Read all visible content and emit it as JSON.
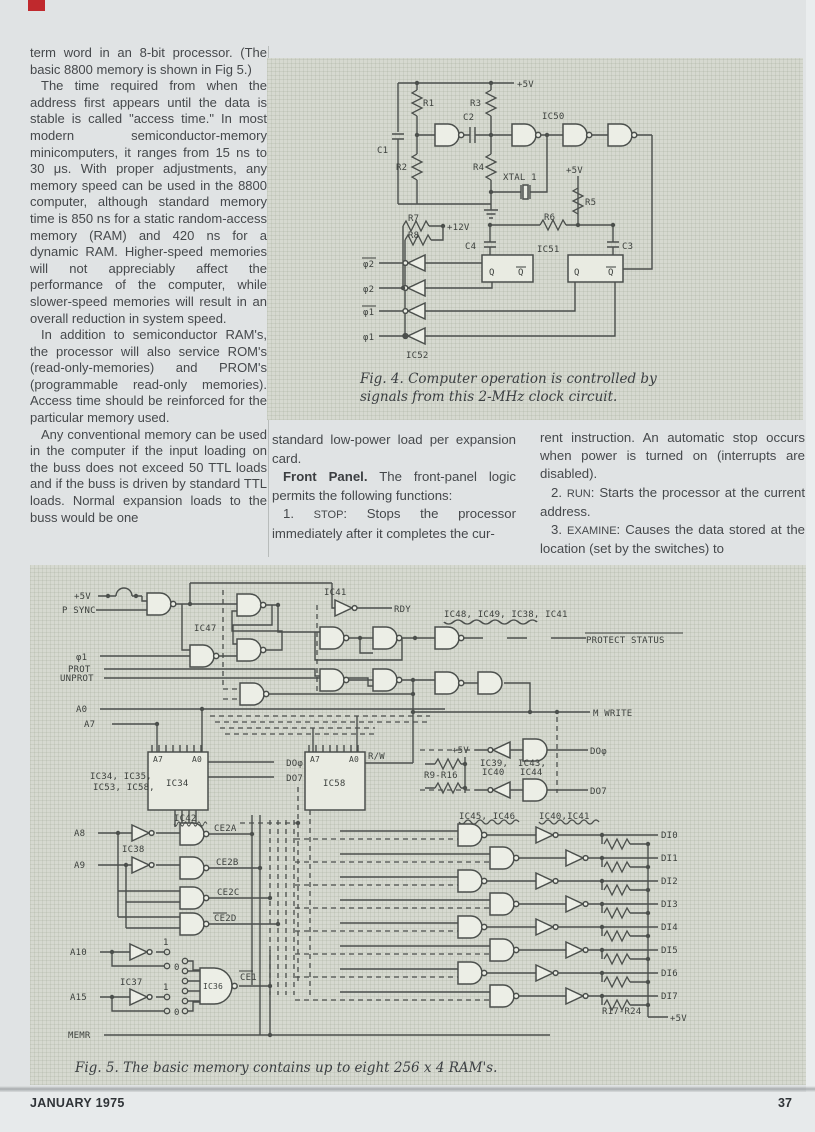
{
  "page": {
    "footer_left": "JANUARY 1975",
    "footer_right": "37"
  },
  "columns": {
    "left_p1": "term word in an 8-bit processor. (The basic 8800 memory is shown in Fig 5.)",
    "left_p2": "The time required from when the address first appears until the data is stable is called \"access time.\" In most modern semiconductor-memory minicomputers, it ranges from 15 ns to 30 μs. With proper adjustments, any memory speed can be used in the 8800 computer, although standard memory time is 850 ns for a static random-access memory (RAM) and 420 ns for a dynamic RAM. Higher-speed memories will not appreciably affect the performance of the computer, while slower-speed memories will result in an overall reduction in system speed.",
    "left_p3": "In addition to semiconductor RAM's, the processor will also service ROM's (read-only-memories) and PROM's (programmable read-only memories). Access time should be reinforced for the particular memory used.",
    "left_p4": "Any conventional memory can be used in the computer if the input loading on the buss does not exceed 50 TTL loads and if the buss is driven by standard TTL loads. Normal expansion loads to the buss would be one",
    "mid_p1": "standard low-power load per expansion card.",
    "mid_heading": "Front Panel.",
    "mid_p2_rest": " The front-panel logic permits the following functions:",
    "item1_num": "1. ",
    "item1_kw": "STOP",
    "item1_rest": ": Stops the processor immediately after it completes the cur-",
    "right_p1": "rent instruction. An automatic stop occurs when power is turned on (interrupts are disabled).",
    "item2_num": "2. ",
    "item2_kw": "RUN",
    "item2_rest": ": Starts the processor at the current address.",
    "item3_num": "3. ",
    "item3_kw": "EXAMINE",
    "item3_rest": ": Causes the data stored at the location (set by the switches) to"
  },
  "fig4": {
    "caption_line1": "Fig. 4. Computer operation is controlled by",
    "caption_line2": "signals from this 2-MHz clock circuit.",
    "labels": {
      "v5": "+5V",
      "r1": "R1",
      "r2": "R2",
      "r3": "R3",
      "r4": "R4",
      "r5": "R5",
      "r6": "R6",
      "r7": "R7",
      "r8": "R8",
      "v12": "+12V",
      "c1": "C1",
      "c2": "C2",
      "c3": "C3",
      "c4": "C4",
      "ic50": "IC50",
      "ic51": "IC51",
      "ic52": "IC52",
      "xtal": "XTAL 1",
      "q": "Q",
      "phi2_bar": "φ2",
      "phi2": "φ2",
      "phi1_bar": "φ1",
      "phi1": "φ1"
    }
  },
  "fig5": {
    "caption": "Fig. 5. The basic memory contains up to eight 256 x 4 RAM's.",
    "labels": {
      "v5": "+5V",
      "psync": "P SYNC",
      "phi1": "φ1",
      "prot": "PROT",
      "unprot": "UNPROT",
      "ic47": "IC47",
      "ic41": "IC41",
      "rdy": "RDY",
      "grp_protect": "IC48, IC49, IC38, IC41",
      "protect_status": "PROTECT STATUS",
      "mwrite": "M WRITE",
      "a0": "A0",
      "a7": "A7",
      "a8": "A8",
      "a9": "A9",
      "a10": "A10",
      "a15": "A15",
      "chips1": "IC34, IC35,",
      "chips2": "IC53, IC58,",
      "ic34": "IC34",
      "ic58": "IC58",
      "ic36": "IC36",
      "ic37": "IC37",
      "ic38": "IC38",
      "ic42": "IC42",
      "do0": "DOφ",
      "do7": "DO7",
      "rw": "R/W",
      "r9r16": "R9-R16",
      "ic39": "IC39,",
      "ic40": "IC40",
      "ic43": "IC43,",
      "ic44": "IC44",
      "grp_ic4546": "IC45, IC46",
      "grp_ic4041": "IC40,IC41",
      "ce2a": "CE2A",
      "ce2b": "CE2B",
      "ce2c": "CE2C",
      "ce2d": "CE2D",
      "ce1": "CE1",
      "memr": "MEMR",
      "jmp1": "1",
      "jmp0": "0",
      "di": [
        "DI0",
        "DI1",
        "DI2",
        "DI3",
        "DI4",
        "DI5",
        "DI6",
        "DI7"
      ],
      "r17r24": "R17-R24"
    }
  }
}
